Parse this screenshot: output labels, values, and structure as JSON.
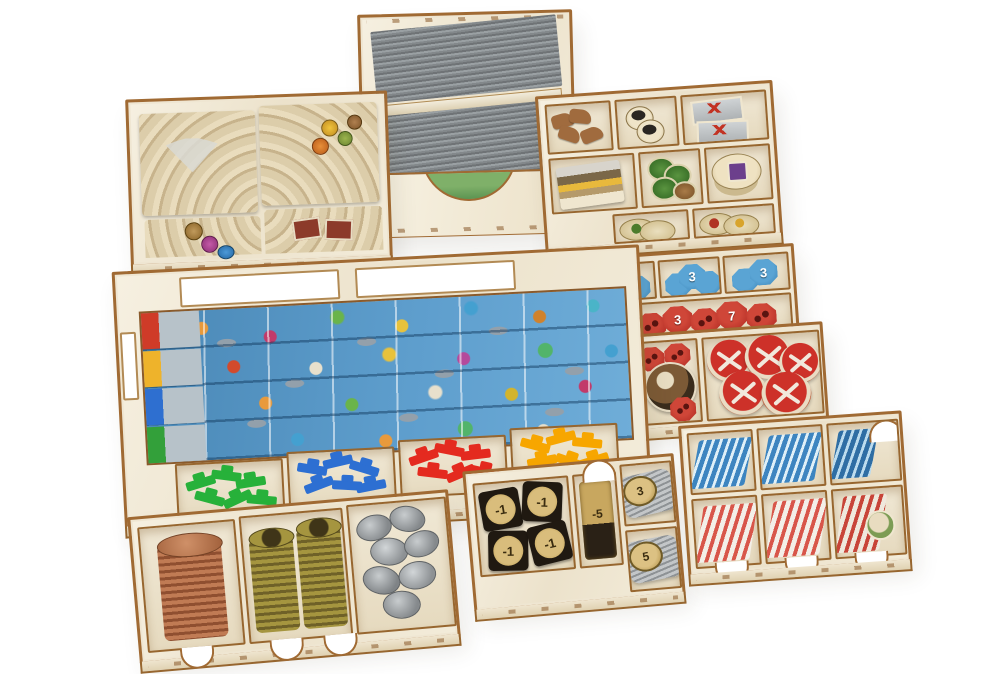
{
  "scene": {
    "description": "Product photograph of a laser-cut plywood board-game organizer: nine birch trays filled with components on a white background",
    "background_color": "#ffffff",
    "wood_face_color": "#f2ecdc",
    "wood_edge_color": "#a06a33"
  },
  "trays": {
    "tile_tray": {
      "name": "player tile tray",
      "contents": "four stacks of square amphitheater tiles with colored resource dots"
    },
    "card_box": {
      "name": "card holder box",
      "contents": "two rows of grey sleeved cards, front cut-out shows a green landscape card",
      "card_back_color": "#8c9093"
    },
    "topright_tray": {
      "name": "token tray",
      "contents": "wood animal meeples, round tokens, grey tiles with red cross, striped tile stack, green tokens, oval tokens"
    },
    "military_tray": {
      "name": "military token tray",
      "contents": "blue victory tokens and red battle tokens"
    },
    "disc_tray": {
      "name": "large disc tray",
      "contents": "red shield discs with crossed-sword emblem and a creature disc"
    },
    "board_tray": {
      "name": "player board tray",
      "contents": "four folded blue sea boards with icon tracks and four bins of ship meeples",
      "meeple_colors": [
        "#27b13a",
        "#2d6fd2",
        "#e42a1f",
        "#f7a600"
      ]
    },
    "coin_tray": {
      "name": "coin tray",
      "contents": "copper coin stack, two brass coin stacks, loose silver coins",
      "coin_colors": [
        "#b5714f",
        "#9a8a3a",
        "#9fa3a6"
      ]
    },
    "debt_tray": {
      "name": "debt token tray",
      "contents": "black square tokens, token stack, two angled rolls of round tokens"
    },
    "slot_tray": {
      "name": "tile slot tray",
      "contents": "back row blue wave tiles, front row red striped tiles, six slots"
    }
  },
  "tokens": {
    "blue": [
      "1",
      "3",
      "3"
    ],
    "red": [
      "7",
      "3",
      "7"
    ],
    "debt_tile": "-1",
    "debt_stack": "-5",
    "coin_rolls": [
      "3",
      "5"
    ]
  }
}
